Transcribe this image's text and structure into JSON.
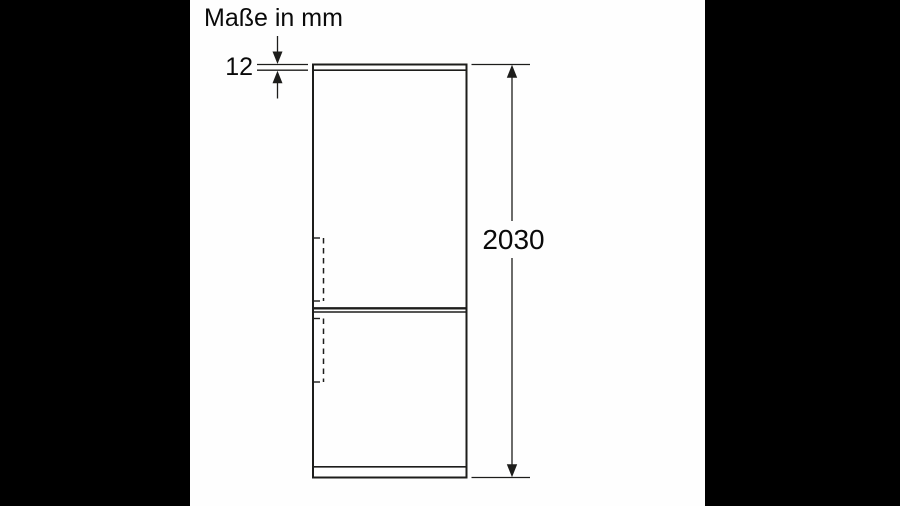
{
  "window": {
    "background_color": "#000000",
    "canvas_color": "#fefefe"
  },
  "header": {
    "units_label": "Maße in mm"
  },
  "diagram": {
    "subject": "fridge-freezer-front-elevation",
    "line_color": "#1d1d1b",
    "text_color": "#0a0a0a",
    "dimensions": [
      {
        "id": "top-plate-thickness",
        "value": "12",
        "unit": "mm"
      },
      {
        "id": "overall-height",
        "value": "2030",
        "unit": "mm"
      }
    ]
  }
}
